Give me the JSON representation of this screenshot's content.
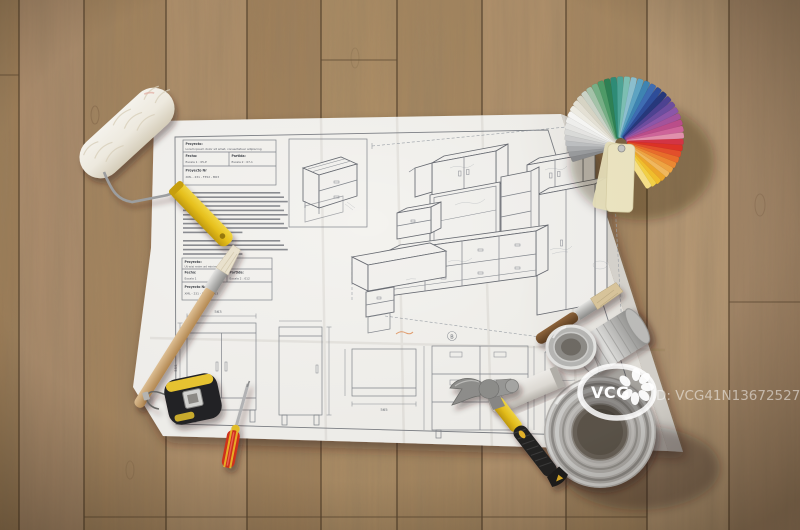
{
  "photo": {
    "alt": "Top-down photo of a furniture blueprint lying on an oak plank floor, surrounded by a paint roller, paintbrushes, colour fan deck, paint cans, hammer, tape measure and screwdriver"
  },
  "watermark": {
    "logo": "VCG",
    "id": "ID: VCG41N1367252723",
    "color": "#ffffff"
  },
  "paper": {
    "title_block_top": {
      "proyecto_label": "Proyecto:",
      "proyecto_value": "Lorem ipsum dolor sit amet, consectetuer adipiscing",
      "fecha_label": "Fecha:",
      "fecha_value": "Escala 1 :  05-P",
      "partida_label": "Partida:",
      "partida_value": "Escala 2 :  07-1",
      "nr_label": "Proyecto Nr",
      "nr_value": "XML - 231 - F352 - M03"
    },
    "title_block_mid": {
      "proyecto_label": "Proyecto:",
      "proyecto_value": "Ut wisi enim ad minim veniam",
      "fecha_label": "Fecha:",
      "fecha_value": "Escala 1",
      "partida_label": "Partida:",
      "partida_value": "Escala 2 :  012",
      "nr_label": "Proyecto Nr",
      "nr_value": "XML - 231 - F352 - M03"
    },
    "dims": {
      "w1": "563",
      "h1": "555",
      "w2": "565",
      "h2": "90",
      "section": "B"
    }
  },
  "fan_deck": {
    "top_card_color": "#efe8c4",
    "colors": [
      "#8a8c8e",
      "#9b9da0",
      "#aeb0b2",
      "#c0c2c4",
      "#d0d1d1",
      "#dedfdd",
      "#eaeae8",
      "#f4f4f2",
      "#fbfbf9",
      "#f3f1e8",
      "#e9e6da",
      "#dcd9ca",
      "#cfd8cc",
      "#a8c8ae",
      "#7ab48a",
      "#4f9e6a",
      "#2f8456",
      "#2f8f7a",
      "#4fa89a",
      "#7fc4b8",
      "#8fc4d4",
      "#5fa8c8",
      "#3f88b8",
      "#3f6fb8",
      "#2f4f9e",
      "#27397f",
      "#4f4496",
      "#6f4fa4",
      "#8f58ae",
      "#a855a0",
      "#c04f8e",
      "#d4679e",
      "#e894b2",
      "#d93546",
      "#e23327",
      "#e9512c",
      "#ef6f2c",
      "#f28c34",
      "#f5a844",
      "#f7bc60",
      "#f3ab2c",
      "#f6c22e",
      "#f8d649",
      "#fae48c"
    ]
  },
  "palette": {
    "wood": "#ac8a63",
    "wood_seam": "#5e4a33",
    "paper": "#f4f3f0",
    "line_art": "#82868c",
    "roller_handle_yellow": "#e9c52a",
    "tape_yellow": "#edc832",
    "screwdriver_red": "#d5311f",
    "hammer_yellow": "#e8b62a",
    "hammer_grip": "#232323",
    "can_silver": "#c6c6c4",
    "brush_wood": "#d2ad7a",
    "bristle": "#e9e1cc"
  }
}
